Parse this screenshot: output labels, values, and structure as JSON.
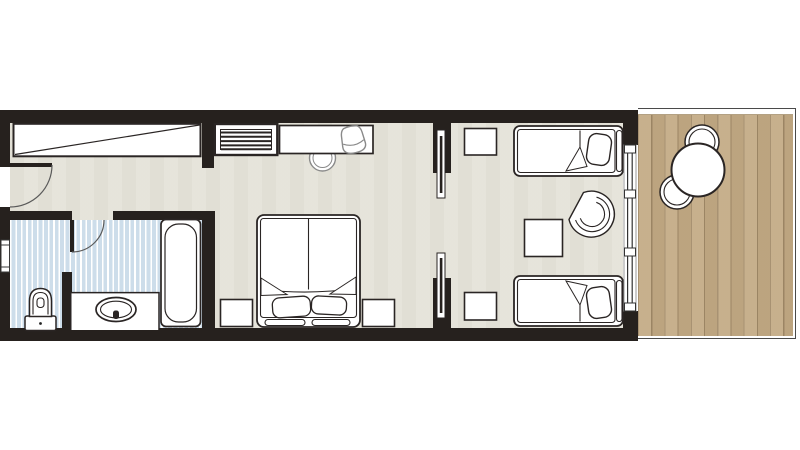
{
  "title": "hotel-guestroom-floor-plan",
  "palette": {
    "wall": "#26211e",
    "floor": "#e6e4da",
    "bath": "#cdddea",
    "bath_stripe": "#ffffff",
    "deck": "#c3aa84",
    "deck_line": "#a18a68",
    "outline": "#2a2524",
    "outline_light": "#8a8a8a",
    "arc": "#5a5a5a",
    "paper": "#ffffff",
    "balcony_border": "#4a4a4a"
  },
  "rooms": [
    {
      "name": "entry-hall",
      "floor": "parquet",
      "features": [
        "entry-door",
        "built-in-wardrobe"
      ]
    },
    {
      "name": "bathroom",
      "floor": "blue-striped-tile",
      "features": [
        "bathtub",
        "washbasin-counter",
        "toilet",
        "hinged-door",
        "small-window",
        "wc-partition"
      ]
    },
    {
      "name": "bedroom",
      "floor": "parquet",
      "features": [
        "double-bed",
        "nightstand-left",
        "nightstand-right",
        "luggage-bench",
        "desk",
        "desk-chair",
        "stool"
      ]
    },
    {
      "name": "twin-lounge-room",
      "floor": "parquet",
      "features": [
        "twin-bed-top",
        "twin-bed-bottom",
        "nightstand-top",
        "nightstand-bottom",
        "side-table",
        "armchair",
        "pocket-door-top",
        "pocket-door-bottom",
        "sliding-glass-door"
      ]
    },
    {
      "name": "balcony",
      "floor": "wood-deck",
      "features": [
        "round-table",
        "chair",
        "chair"
      ]
    }
  ]
}
